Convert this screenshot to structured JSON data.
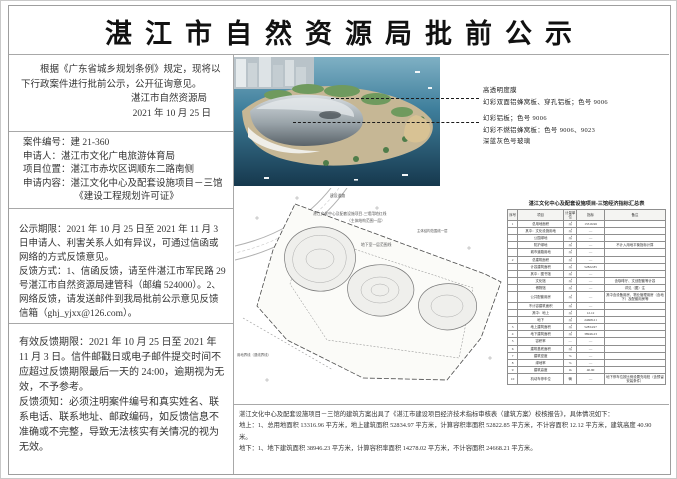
{
  "title": "湛江市自然资源局批前公示",
  "intro": {
    "body": "根据《广东省城乡规划条例》规定，现将以下行政案件进行批前公示，公开征询意见。",
    "org": "湛江市自然资源局",
    "date": "2021 年 10 月 25 日"
  },
  "case_info": {
    "case_no": "案件编号：建 21-360",
    "applicant": "申请人：湛江市文化广电旅游体育局",
    "location": "项目位置：湛江市赤坎区调顺东二路南侧",
    "content": "申请内容：湛江文化中心及配套设施项目－三馆",
    "permit": "《建设工程规划许可证》"
  },
  "notice": {
    "period": "公示期限：2021 年 10 月 25 日至 2021 年 11 月 3 日申请人、利害关系人如有异议，可通过信函或网络的方式反馈意见。",
    "methods": "反馈方式：1、信函反馈，请至件湛江市军民路 29 号湛江市自然资源局建管科（邮编 524000）。2、网络反馈，请发送邮件到我局批前公示意见反馈信箱（ghj_yjxx@126.com）。"
  },
  "valid_feedback": {
    "deadline": "有效反馈期限：2021 年 10 月 25 日至 2021 年 11 月 3 日。信件邮戳日或电子邮件提交时间不应超过反馈期限最后一天的 24:00，逾期视为无效，不予参考。",
    "requirements": "反馈须知：必须注明案件编号和真实姓名、联系电话、联系地址、邮政编码，如反馈信息不准确或不完整，导致无法核实有关情况的视为无效。"
  },
  "render_annotations": {
    "group1": [
      "高透明度膜",
      "幻彩双面铝蜂窝板、穿孔铝板；色号 9006"
    ],
    "group2": [
      "幻彩铝板；色号 9006",
      "幻彩不燃铝蜂窝板：色号 9006、9023",
      "深蓝灰色号玻璃"
    ]
  },
  "site_plan": {
    "label_road": "建设道路",
    "label_redline": "湛江文化中心及配套设施项目-三馆用地红线",
    "label_redline2": "（主体结构范围一层）",
    "label_structure": "主体结构范围线一层",
    "label_basement": "地下室一层范围线",
    "label_boundary": "用地界线（退线界线）"
  },
  "table": {
    "title": "湛江文化中心及配套设施项目-三馆经济指标汇总表",
    "headers": [
      "序号",
      "项目",
      "计量单位",
      "指标",
      "备注"
    ],
    "rows": [
      [
        "1",
        "总用地面积",
        "㎡",
        "13316.96",
        ""
      ],
      [
        "",
        "其中：文化设施用地",
        "㎡",
        "—",
        ""
      ],
      [
        "",
        "公园绿地",
        "㎡",
        "—",
        ""
      ],
      [
        "",
        "防护绿地",
        "㎡",
        "—",
        "不计入用地平衡指标计算"
      ],
      [
        "",
        "城市道路用地",
        "㎡",
        "—",
        ""
      ],
      [
        "2",
        "总建筑面积",
        "㎡",
        "—",
        ""
      ],
      [
        "",
        "计容建筑面积",
        "㎡",
        "52822.85",
        ""
      ],
      [
        "",
        "其中：图书馆",
        "㎡",
        "—",
        ""
      ],
      [
        "",
        "文化馆",
        "㎡",
        "—",
        "含咖啡厅、文创配套等计容"
      ],
      [
        "",
        "博物馆",
        "㎡",
        "—",
        "详见（图）注"
      ],
      [
        "",
        "公共配套用房",
        "㎡",
        "—",
        "其中含设备用房、物业管理用房（含地下）及配套用房等"
      ],
      [
        "",
        "不计容建筑面积",
        "㎡",
        "—",
        ""
      ],
      [
        "",
        "其中：地上",
        "㎡",
        "12.12",
        ""
      ],
      [
        "",
        "地下",
        "㎡",
        "24668.21",
        ""
      ],
      [
        "3",
        "地上建筑面积",
        "㎡",
        "52834.97",
        ""
      ],
      [
        "4",
        "地下建筑面积",
        "㎡",
        "38946.23",
        ""
      ],
      [
        "5",
        "容积率",
        "—",
        "—",
        ""
      ],
      [
        "6",
        "建筑基底面积",
        "㎡",
        "—",
        ""
      ],
      [
        "7",
        "建筑密度",
        "%",
        "—",
        ""
      ],
      [
        "8",
        "绿地率",
        "%",
        "—",
        ""
      ],
      [
        "9",
        "建筑高度",
        "m",
        "40.90",
        ""
      ],
      [
        "10",
        "机动车停车位",
        "辆",
        "—",
        "地下停车位按比例设置充电桩（含预留安装条件）"
      ]
    ]
  },
  "footer": {
    "line1": "湛江文化中心及配套设施项目－三馆的建筑方案出具了《湛江市建设项目经济技术指标审核表（建筑方案）校核报告》，具体情况如下：",
    "line2": "地上：1、总用地面积 13316.96 平方米，地上建筑面积 52834.97 平方米，计算容积率面积 52822.85 平方米，不计容面积 12.12 平方米，建筑高度 40.90 米。",
    "line3": "地下：1、地下建筑面积 38946.23 平方米，计算容积率面积 14278.02 平方米，不计容面积 24668.21 平方米。"
  }
}
